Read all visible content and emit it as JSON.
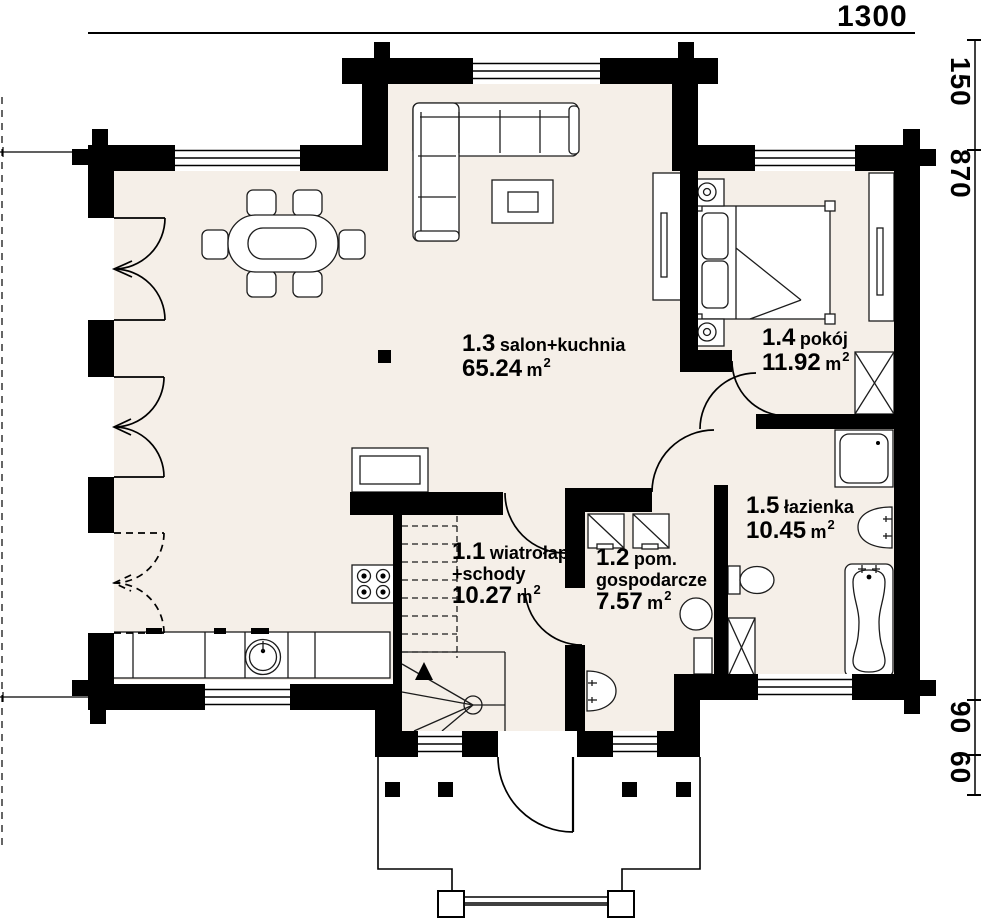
{
  "plan": {
    "area_unit": "m",
    "area_unit_sup": "2",
    "rooms": [
      {
        "number": "1.1",
        "name": "wiatrołap",
        "name2": "+schody",
        "area": "10.27"
      },
      {
        "number": "1.2",
        "name": "pom.",
        "name2": "gospodarcze",
        "area": "7.57"
      },
      {
        "number": "1.3",
        "name": "salon+kuchnia",
        "area": "65.24"
      },
      {
        "number": "1.4",
        "name": "pokój",
        "area": "11.92"
      },
      {
        "number": "1.5",
        "name": "łazienka",
        "area": "10.45"
      }
    ],
    "dimensions": {
      "top": "1300",
      "right_150": "150",
      "right_870": "870",
      "right_90": "90",
      "right_60": "60"
    },
    "furniture_symbols": [
      "corner-sofa",
      "coffee-table",
      "dining-table-6-chairs",
      "kitchen-counter-sink",
      "stove",
      "kitchen-island",
      "double-bed",
      "nightstand-lamps",
      "wardrobe",
      "chimney-shaft",
      "shower",
      "washbasin",
      "toilet",
      "bathtub",
      "washer-dryer",
      "water-heater",
      "winder-stairs",
      "entrance-door",
      "porch-columns"
    ],
    "colors": {
      "floor": "#f5efe8",
      "wall": "#000000",
      "background": "#ffffff",
      "line": "#1c1c1c"
    }
  }
}
